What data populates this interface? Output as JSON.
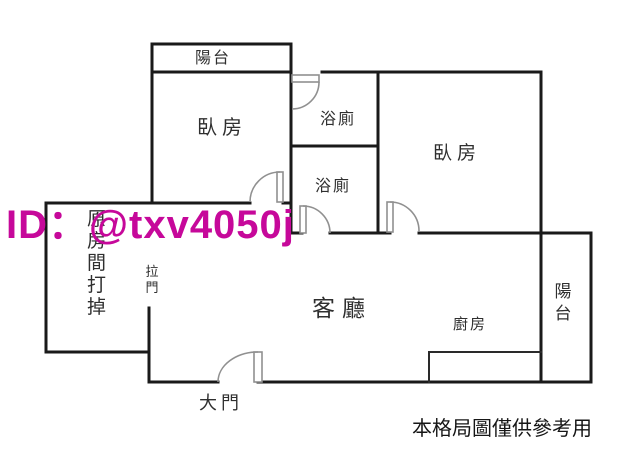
{
  "title": "apartment floor plan",
  "watermark": {
    "text": "ID：@txv4050j",
    "color": "#c6089a"
  },
  "disclaimer": "本格局圖僅供參考用",
  "rooms": {
    "balcony_top": "陽台",
    "bedroom_left": "臥房",
    "bathroom_upper": "浴廁",
    "bathroom_lower": "浴廁",
    "bedroom_right": "臥房",
    "living_room": "客廳",
    "kitchen": "廚房",
    "balcony_right": "陽台"
  },
  "annotations": {
    "sliding_door": "拉門",
    "demolished_note": "原房間打掉",
    "main_door": "大門"
  },
  "colors": {
    "wall": "#1a1a1a",
    "door": "#909090",
    "label": "#2f2f2f"
  }
}
